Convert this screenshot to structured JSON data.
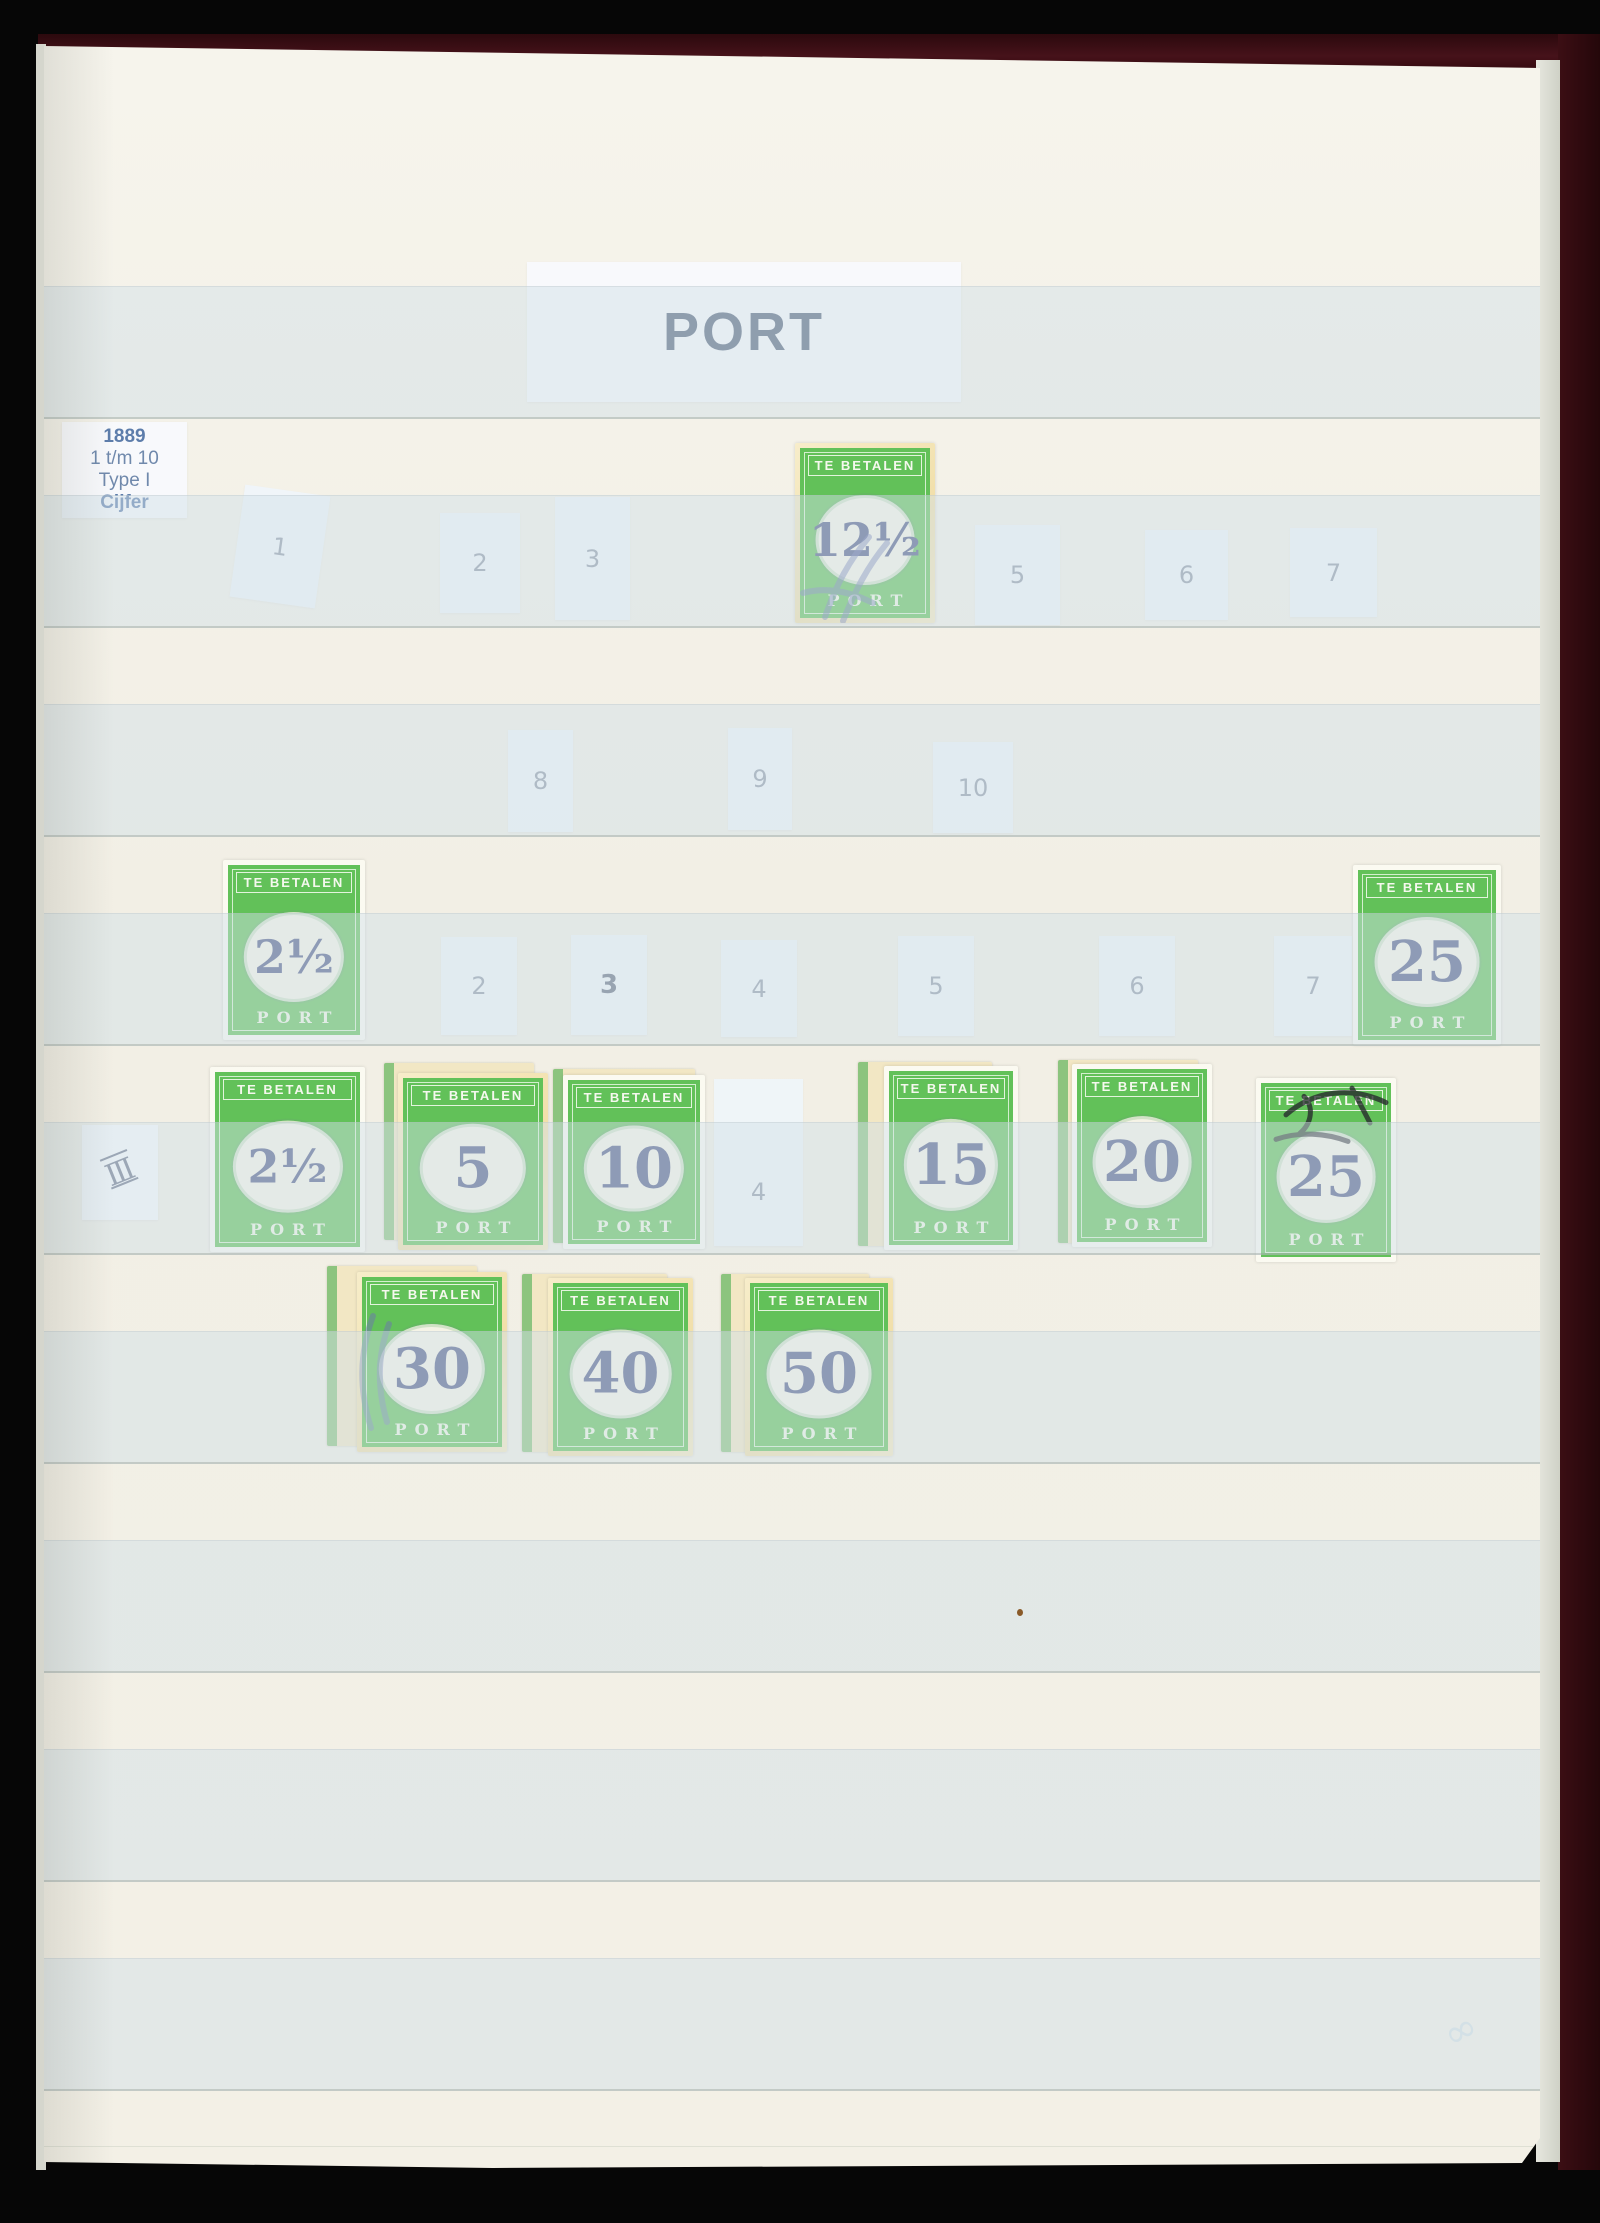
{
  "album": {
    "title": "PORT",
    "period_label": {
      "year": "1889",
      "range": "1 t/m 10",
      "type": "Type I",
      "kind": "Cijfer"
    },
    "margin_mark": "Ⅲ",
    "corner_squiggle": "∞",
    "stamp_design": {
      "top_text": "TE BETALEN",
      "bottom_text": "PORT"
    },
    "colors": {
      "stamp_green": "#62c159",
      "numeral_blue": "#525c88",
      "page_cream": "#f2efe5",
      "film_blue": "#d1dfe8",
      "title_navy": "#53627a",
      "label_blue": "#5d7dab",
      "slip_number_gray": "#9199a8",
      "album_cover_maroon": "#46121a",
      "cancel_blue": "#6d77b0",
      "cancel_black": "#23232a"
    },
    "slips": [
      {
        "label": "1",
        "x": 193,
        "y": 444,
        "w": 86,
        "h": 113,
        "rot": 8
      },
      {
        "label": "2",
        "x": 396,
        "y": 467,
        "w": 80,
        "h": 100,
        "rot": 0
      },
      {
        "label": "3",
        "x": 511,
        "y": 451,
        "w": 75,
        "h": 123,
        "rot": 0
      },
      {
        "label": "5",
        "x": 931,
        "y": 479,
        "w": 85,
        "h": 100,
        "rot": 0
      },
      {
        "label": "6",
        "x": 1101,
        "y": 484,
        "w": 83,
        "h": 90,
        "rot": 0
      },
      {
        "label": "7",
        "x": 1246,
        "y": 482,
        "w": 87,
        "h": 89,
        "rot": 0
      },
      {
        "label": "8",
        "x": 464,
        "y": 684,
        "w": 65,
        "h": 102,
        "rot": 0
      },
      {
        "label": "9",
        "x": 684,
        "y": 682,
        "w": 64,
        "h": 102,
        "rot": 0
      },
      {
        "label": "10",
        "x": 889,
        "y": 696,
        "w": 80,
        "h": 91,
        "rot": 0
      },
      {
        "label": "2",
        "x": 397,
        "y": 891,
        "w": 76,
        "h": 98,
        "rot": 0
      },
      {
        "label": "3",
        "x": 527,
        "y": 889,
        "w": 76,
        "h": 100,
        "rot": 0,
        "bold": true
      },
      {
        "label": "4",
        "x": 677,
        "y": 894,
        "w": 76,
        "h": 97,
        "rot": 0
      },
      {
        "label": "5",
        "x": 854,
        "y": 890,
        "w": 76,
        "h": 100,
        "rot": 0
      },
      {
        "label": "6",
        "x": 1055,
        "y": 890,
        "w": 76,
        "h": 100,
        "rot": 0
      },
      {
        "label": "7",
        "x": 1230,
        "y": 890,
        "w": 78,
        "h": 100,
        "rot": 0
      },
      {
        "label": "4",
        "x": 670,
        "y": 1033,
        "w": 89,
        "h": 167,
        "rot": 0,
        "low": true
      }
    ],
    "stamps": [
      {
        "value": "12½",
        "x": 751,
        "y": 397,
        "w": 140,
        "h": 180,
        "toned": true,
        "cancel": "blue"
      },
      {
        "value": "2½",
        "x": 179,
        "y": 814,
        "w": 142,
        "h": 180
      },
      {
        "value": "25",
        "x": 1309,
        "y": 819,
        "w": 148,
        "h": 180
      },
      {
        "value": "2½",
        "x": 166,
        "y": 1021,
        "w": 155,
        "h": 185
      },
      {
        "value": "5",
        "x": 354,
        "y": 1027,
        "w": 150,
        "h": 177,
        "toned": true,
        "behind": {
          "dx": -14,
          "dy": -10
        }
      },
      {
        "value": "10",
        "x": 519,
        "y": 1029,
        "w": 142,
        "h": 174,
        "behind": {
          "dx": -10,
          "dy": -6
        }
      },
      {
        "value": "15",
        "x": 840,
        "y": 1020,
        "w": 134,
        "h": 184,
        "behind": {
          "dx": -26,
          "dy": -4
        }
      },
      {
        "value": "20",
        "x": 1028,
        "y": 1018,
        "w": 140,
        "h": 183,
        "behind": {
          "dx": -14,
          "dy": -4
        }
      },
      {
        "value": "25",
        "x": 1212,
        "y": 1032,
        "w": 140,
        "h": 184,
        "cancel": "black"
      },
      {
        "value": "30",
        "x": 313,
        "y": 1226,
        "w": 150,
        "h": 180,
        "toned": true,
        "behind": {
          "dx": -30,
          "dy": -6
        },
        "cancel": "blue-left"
      },
      {
        "value": "40",
        "x": 504,
        "y": 1232,
        "w": 145,
        "h": 178,
        "toned": true,
        "behind": {
          "dx": -26,
          "dy": -4
        }
      },
      {
        "value": "50",
        "x": 701,
        "y": 1232,
        "w": 148,
        "h": 178,
        "toned": true,
        "behind": {
          "dx": -24,
          "dy": -4
        }
      }
    ],
    "film_strip_tops": [
      240,
      449,
      658,
      867,
      1076,
      1285,
      1494,
      1703,
      1912
    ]
  }
}
